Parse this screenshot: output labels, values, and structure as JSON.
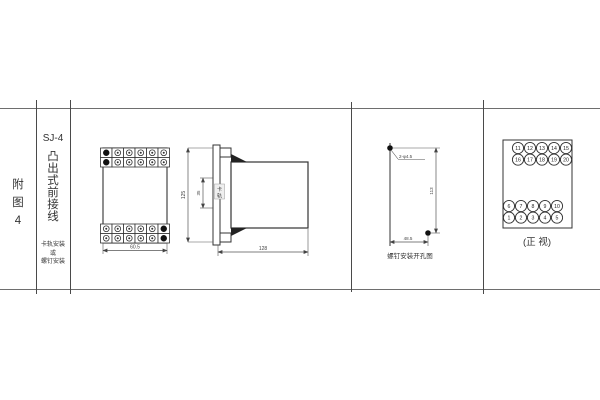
{
  "left_panel": {
    "figure_chars": [
      "附",
      "图",
      "4"
    ],
    "model": "SJ-4",
    "type_chars": [
      "凸",
      "出",
      "式",
      "前",
      "接",
      "线"
    ],
    "mount_lines": [
      "卡轨安装",
      "或",
      "螺钉安装"
    ]
  },
  "front_view": {
    "width_dim": "60.5"
  },
  "side_view": {
    "height_dim": "125",
    "rail_dim": "35",
    "rail_chars": [
      "卡",
      "轨"
    ],
    "depth_dim": "128"
  },
  "drill_view": {
    "hole_label": "2-φ4.5",
    "height_dim": "113",
    "width_dim": "48.5",
    "caption": "螺钉安装开孔图"
  },
  "terminal_view": {
    "rows": {
      "r1": [
        "11",
        "12",
        "13",
        "14",
        "15"
      ],
      "r2": [
        "16",
        "17",
        "18",
        "19",
        "20"
      ],
      "r3": [
        "6",
        "7",
        "8",
        "9",
        "10"
      ],
      "r4": [
        "1",
        "2",
        "3",
        "4",
        "5"
      ]
    },
    "caption": "(正 视)"
  },
  "colors": {
    "line": "#333333",
    "table_line": "#6e6e6e",
    "dim_text": "#444444"
  }
}
